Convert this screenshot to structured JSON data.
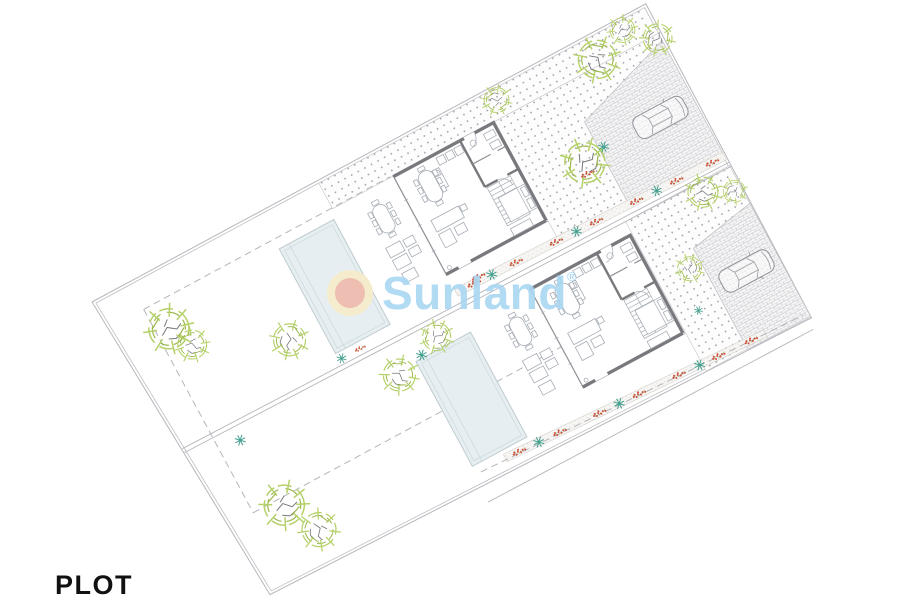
{
  "page": {
    "label": "PLOT"
  },
  "watermark": {
    "text": "Sunland",
    "registered": "®"
  },
  "colors": {
    "logo_blue": "#a9d6f2",
    "logo_ring": "#f7ecca",
    "logo_core": "#efb9ac",
    "line": "#b6b6bc",
    "wall": "#78787d",
    "furniture": "#a7adb5",
    "pool_fill": "#e6eef1",
    "pool_edge": "#bac7cc",
    "tree_green": "#b5d169",
    "branch": "#75787c",
    "flower_red": "#cf4f3b",
    "flower_teal": "#43a08f",
    "dot": "#9b9ba3",
    "brick": "#bcbcc2",
    "label_black": "#111111"
  },
  "plan": {
    "type": "site-plan",
    "plots": [
      {
        "name": "plot-1",
        "features": [
          "villa",
          "pool",
          "terrace",
          "garden-trees",
          "gravel-garden",
          "paved-driveway",
          "car",
          "flower-border"
        ]
      },
      {
        "name": "plot-2",
        "features": [
          "villa",
          "pool",
          "terrace",
          "garden-trees",
          "gravel-garden",
          "paved-driveway",
          "car",
          "flower-border"
        ]
      }
    ]
  }
}
